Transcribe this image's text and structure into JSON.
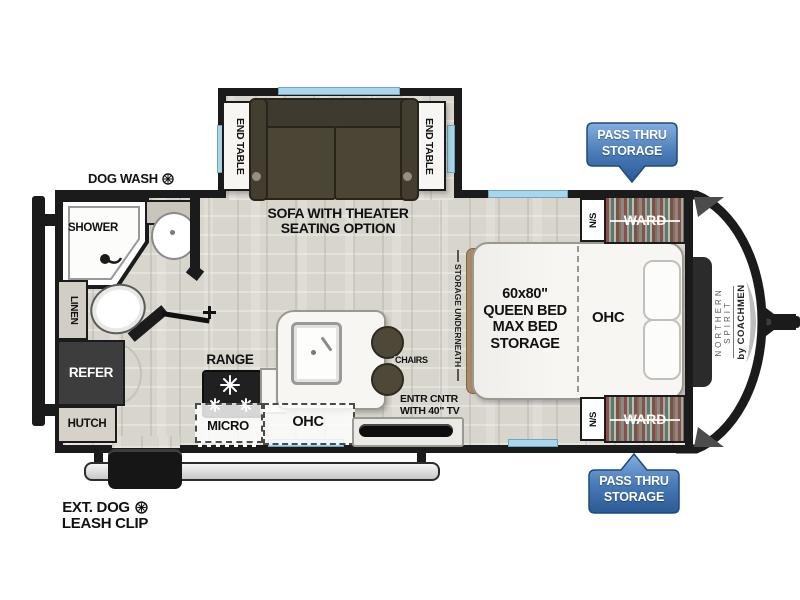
{
  "title": "Travel trailer floor plan",
  "colors": {
    "wall": "#1b1b1b",
    "window_blue": "#a9d6ea",
    "badge_blue_light": "#85aede",
    "badge_blue_dark": "#2a5a96",
    "sofa_brown": "#4b4536",
    "floor_wood": "#d8d5cd",
    "refer_gray": "#3d3d3d"
  },
  "labels": {
    "dog_wash": "DOG WASH",
    "ext_dog_line1": "EXT. DOG",
    "ext_dog_line2": "LEASH CLIP",
    "shower": "SHOWER",
    "linen": "LINEN",
    "refer": "REFER",
    "hutch": "HUTCH",
    "range": "RANGE",
    "micro": "MICRO",
    "ohc_kitchen": "OHC",
    "chairs": "CHAIRS",
    "entr_line1": "ENTR CNTR",
    "entr_line2": "WITH 40\" TV",
    "sofa_line1": "SOFA WITH THEATER",
    "sofa_line2": "SEATING OPTION",
    "end_table_left": "END TABLE",
    "end_table_right": "END TABLE",
    "storage_underneath": "STORAGE UNDERNEATH",
    "bed_line1": "60x80\"",
    "bed_line2": "QUEEN BED",
    "bed_line3": "MAX BED",
    "bed_line4": "STORAGE",
    "ohc_bed": "OHC",
    "ns_top": "N/S",
    "ns_bottom": "N/S",
    "ward_top": "WARD",
    "ward_bottom": "WARD",
    "pass_thru_top_line1": "PASS THRU",
    "pass_thru_top_line2": "STORAGE",
    "pass_thru_bottom_line1": "PASS THRU",
    "pass_thru_bottom_line2": "STORAGE",
    "brand_line1": "NORTHERN",
    "brand_line2": "SPIRIT",
    "brand_line3": "by COACHMEN"
  }
}
